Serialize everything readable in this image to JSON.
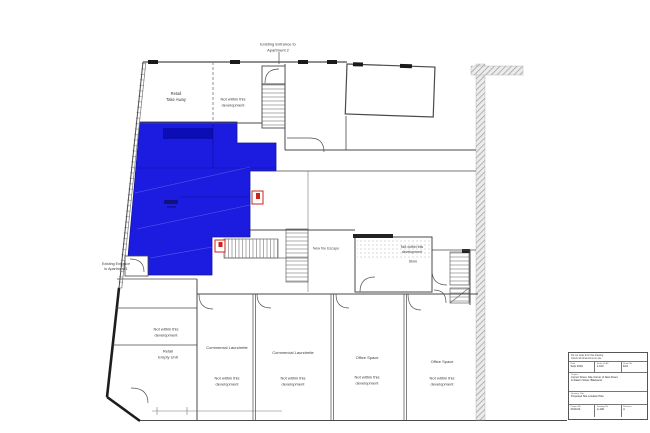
{
  "plan": {
    "labels": {
      "entrance_apt2": "Existing Entrance to\nApartment 2",
      "entrance_apt1": "Existing Entrance\nto Apartment 1",
      "retail_take_away": "Retail\nTake Away",
      "not_within_top": "Not within this\ndevelopment",
      "store_not_within": "Not within this\ndevelopment",
      "store": "Store",
      "new_fire_escape": "New fire Escape",
      "not_within_left": "Not within this\ndevelopment",
      "retail_empty_unit": "Retail\nEmpty Unit"
    },
    "rooms": [
      {
        "name": "Commercial Laundrette",
        "note": "Not within this\ndevelopment"
      },
      {
        "name": "Commercial Laundrette",
        "note": "Not within this\ndevelopment"
      },
      {
        "name": "Office Space",
        "note": "Not within this\ndevelopment"
      },
      {
        "name": "Office Space",
        "note": "Not within this\ndevelopment"
      }
    ],
    "colors": {
      "highlight_blue": "#1c1ce0",
      "fire_door_red": "#cc2418",
      "wall_gray": "#4a4a4a"
    },
    "icons": [
      "fire-door-icon",
      "staircase",
      "door-swing-arc",
      "boundary-hatch"
    ]
  },
  "title_block": {
    "notes_line1": "Do not scale from this drawing.",
    "notes_line2": "Check all dimensions on site.",
    "date_label": "Date",
    "date_value": "Sept 2019",
    "scale_label": "Scale @ A3",
    "scale_value": "1:100",
    "sheet_label": "Sheet No",
    "sheet_value": "E01",
    "project_label": "Project:",
    "project_text": "Corner Street, Site Corner of New Street\n& Station Street, Blackpool",
    "drawing_title_label": "Drawing Title:",
    "drawing_title_text": "Proposed Site Location Plan",
    "project_no_label": "Project No",
    "project_no_value": "2019-04",
    "drawing_no_label": "Drawing No",
    "drawing_no_value": "A-100",
    "revision_label": "Revision",
    "revision_value": "A"
  }
}
